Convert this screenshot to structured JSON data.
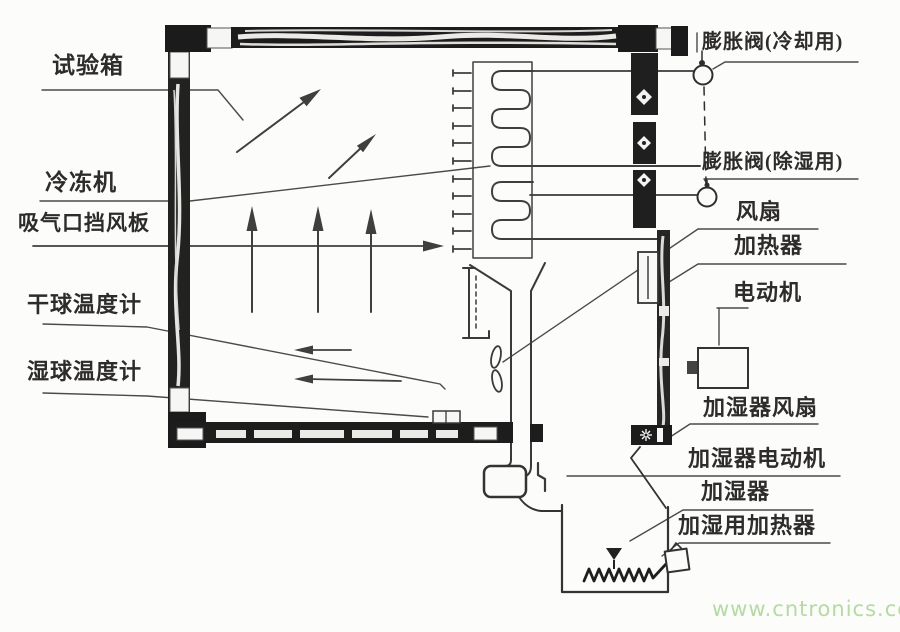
{
  "diagram": {
    "title_context": "environmental-test-chamber-schematic",
    "labels": {
      "test_chamber": "试验箱",
      "refrigerator": "冷冻机",
      "suction_baffle": "吸气口挡风板",
      "dry_bulb_thermometer": "干球温度计",
      "wet_bulb_thermometer": "湿球温度计",
      "expansion_valve_cooling": "膨胀阀(冷却用)",
      "expansion_valve_dehumidify": "膨胀阀(除湿用)",
      "fan": "风扇",
      "heater": "加热器",
      "motor": "电动机",
      "humidifier_fan": "加湿器风扇",
      "humidifier_motor": "加湿器电动机",
      "humidifier": "加湿器",
      "humidifier_heater": "加湿用加热器"
    },
    "watermark": "www.cntronics.com",
    "colors": {
      "ink": "#3a3a3a",
      "wall": "#1d1d1d",
      "watermark_green": "#b5daa2",
      "background": "#fcfcfa"
    }
  }
}
